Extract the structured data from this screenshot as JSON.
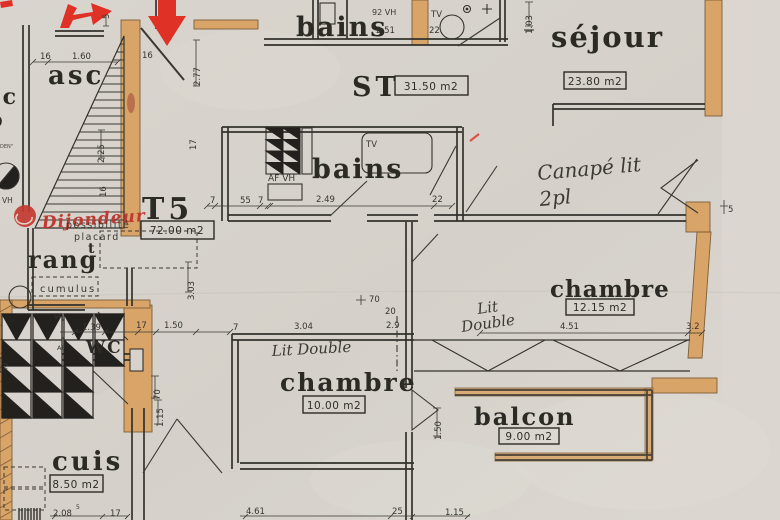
{
  "rooms": {
    "asc": "asc",
    "bains_top": "bains",
    "st": "ST",
    "st_area": "31.50 m2",
    "sejour": "séjour",
    "sejour_area": "23.80 m2",
    "t5": "T5",
    "t5_area": "72.00 m2",
    "bains_mid": "bains",
    "rang": "rang",
    "rang_sup": "t",
    "wc": "WC",
    "chambre_right": "chambre",
    "chambre_right_area": "12.15 m2",
    "chambre_bottom": "chambre",
    "chambre_bottom_area": "10.00 m2",
    "balcon": "balcon",
    "balcon_area": "9.00 m2",
    "cuis": "cuis",
    "cuis_area": "8.50 m2"
  },
  "notes": {
    "stamp": "Dijondeur",
    "possibilite": "possibilité",
    "placard": "placard",
    "cumulus": "cumulus",
    "canape_1": "Canapé lit",
    "canape_2": "2pl",
    "lit_r1": "Lit",
    "lit_r2": "Double",
    "lit_b": "Lit Double",
    "af_vh": "AF VH",
    "tv_bath": "TV",
    "tv_top": "TV",
    "vh_92": "92 VH",
    "vh_left": "VH",
    "vh_wc": "VH",
    "af_wc": "AF",
    "edge_1": "oc",
    "edge_2": "o",
    "edge_3": "DEN\"",
    "box_2": "2"
  },
  "dims": {
    "w16_top": "16",
    "w160": "1.60",
    "w5_top": "5",
    "w16_door": "16",
    "h277": "2.77",
    "h225": "2.25",
    "h16_stair": "16",
    "h103": "1.03",
    "w251": "2.51",
    "w22_top": "22",
    "h17_corr": "17",
    "w7_a": "7",
    "w55": "55",
    "w7_b": "7",
    "w249": "2.49",
    "w22_mid": "22",
    "h303": "3.03",
    "w5_post": "5",
    "w70_door": "70",
    "w20_jamb": "20",
    "w29": "2.9",
    "w139": "1.39",
    "w17_wc": "17",
    "w150_wc": "1.50",
    "w7_c": "7",
    "w304": "3.04",
    "w451": "4.51",
    "w32": "3.2",
    "h70_hall": "70",
    "h115_hall": "1.15",
    "h150_balc": "1.50",
    "w208": "2.08",
    "w208_sup": "5",
    "w17_cuis": "17",
    "w461": "4.61",
    "w25": "25",
    "w115_bot": "1.15"
  }
}
